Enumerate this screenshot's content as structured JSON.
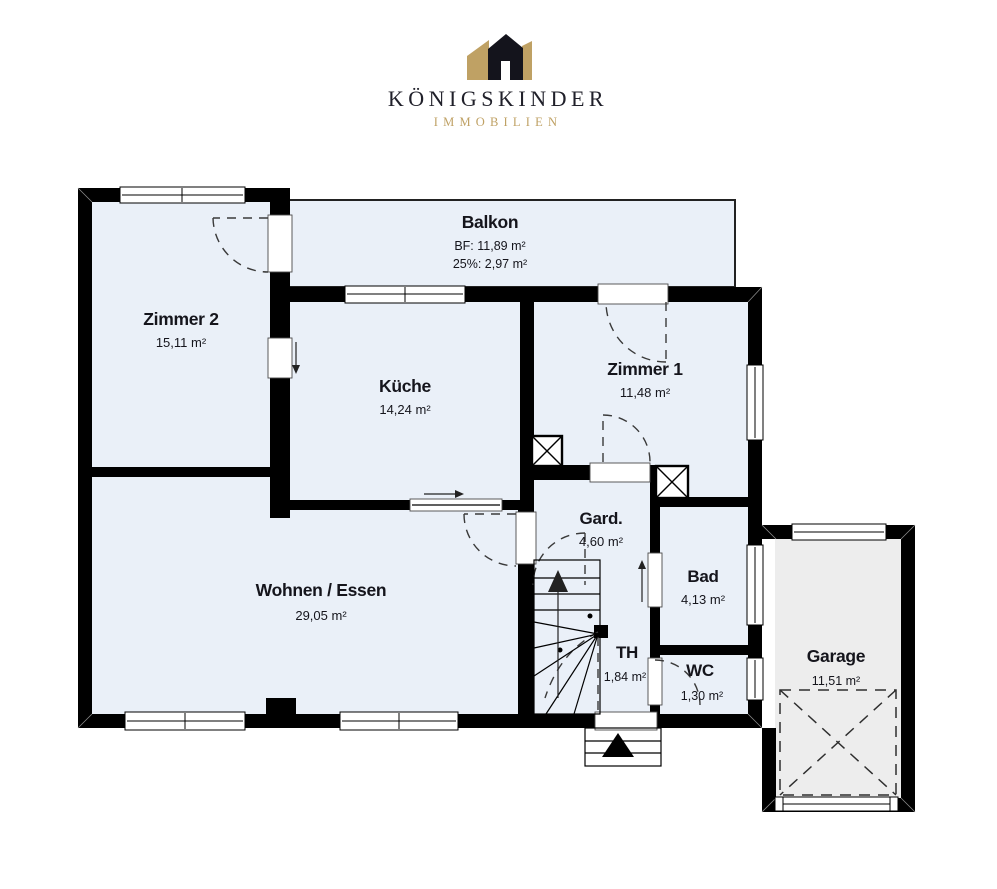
{
  "brand": {
    "title": "KÖNIGSKINDER",
    "subtitle": "IMMOBILIEN"
  },
  "colors": {
    "gold": "#BFA164",
    "brand_text": "#20202A",
    "room_fill": "#EAF0F8",
    "garage_fill": "#EDEDED",
    "wall": "#000000",
    "text": "#15151C"
  },
  "rooms": [
    {
      "id": "balkon",
      "name": "Balkon",
      "area": "BF: 11,89 m²",
      "area2": "25%: 2,97 m²"
    },
    {
      "id": "zimmer-2",
      "name": "Zimmer 2",
      "area": "15,11 m²"
    },
    {
      "id": "kueche",
      "name": "Küche",
      "area": "14,24 m²"
    },
    {
      "id": "zimmer-1",
      "name": "Zimmer 1",
      "area": "11,48 m²"
    },
    {
      "id": "garderobe",
      "name": "Gard.",
      "area": "4,60 m²"
    },
    {
      "id": "bad",
      "name": "Bad",
      "area": "4,13 m²"
    },
    {
      "id": "wohnen-essen",
      "name": "Wohnen / Essen",
      "area": "29,05 m²"
    },
    {
      "id": "treppenhaus",
      "name": "TH",
      "area": "1,84 m²"
    },
    {
      "id": "wc",
      "name": "WC",
      "area": "1,30 m²"
    },
    {
      "id": "garage",
      "name": "Garage",
      "area": "11,51 m²"
    }
  ]
}
